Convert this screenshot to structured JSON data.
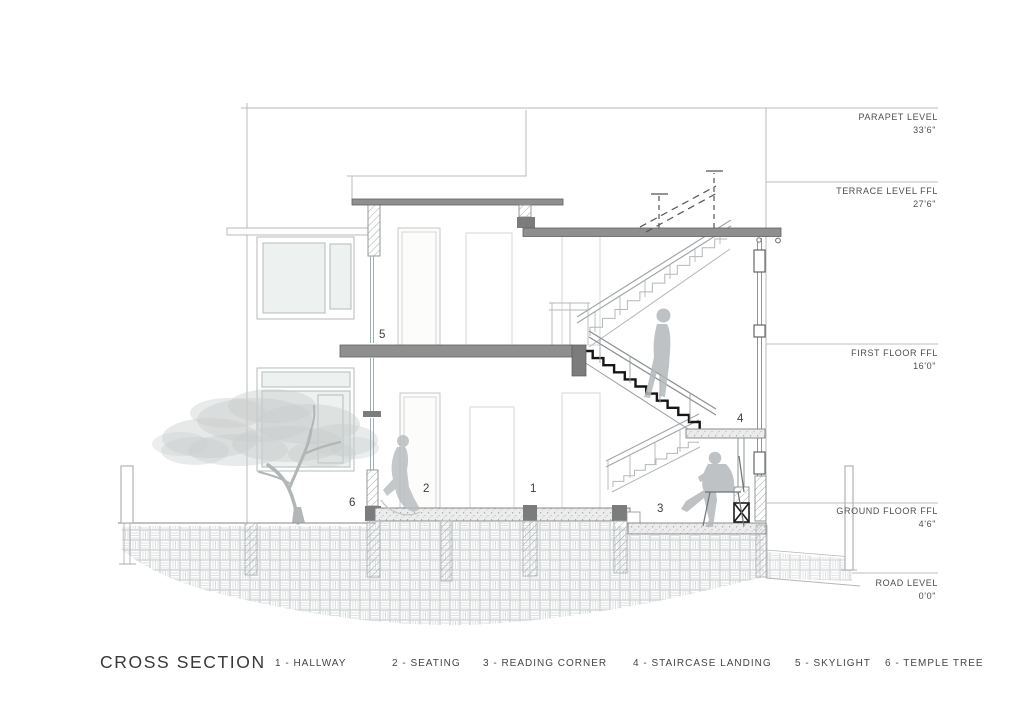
{
  "title": "CROSS SECTION",
  "levels": [
    {
      "name": "PARAPET LEVEL",
      "elevation": "33'6\""
    },
    {
      "name": "TERRACE LEVEL FFL",
      "elevation": "27'6\""
    },
    {
      "name": "FIRST FLOOR FFL",
      "elevation": "16'0\""
    },
    {
      "name": "GROUND FLOOR FFL",
      "elevation": "4'6\""
    },
    {
      "name": "ROAD LEVEL",
      "elevation": "0'0\""
    }
  ],
  "legend": [
    {
      "num": "1",
      "label": "HALLWAY",
      "display": "1 - HALLWAY"
    },
    {
      "num": "2",
      "label": "SEATING",
      "display": "2 - SEATING"
    },
    {
      "num": "3",
      "label": "READING CORNER",
      "display": "3 - READING CORNER"
    },
    {
      "num": "4",
      "label": "STAIRCASE LANDING",
      "display": "4 - STAIRCASE LANDING"
    },
    {
      "num": "5",
      "label": "SKYLIGHT",
      "display": "5 - SKYLIGHT"
    },
    {
      "num": "6",
      "label": "TEMPLE TREE",
      "display": "6 - TEMPLE TREE"
    }
  ],
  "callouts": {
    "hallway": "1",
    "seating": "2",
    "reading_corner": "3",
    "staircase_landing": "4",
    "skylight": "5",
    "temple_tree": "6"
  },
  "colors": {
    "slab_gray": "#8f8f8f",
    "cut_dark": "#7c7c7c",
    "outline_light": "#b7bbbd",
    "tread_black": "#161616",
    "annotation_text": "#4b4e50"
  }
}
